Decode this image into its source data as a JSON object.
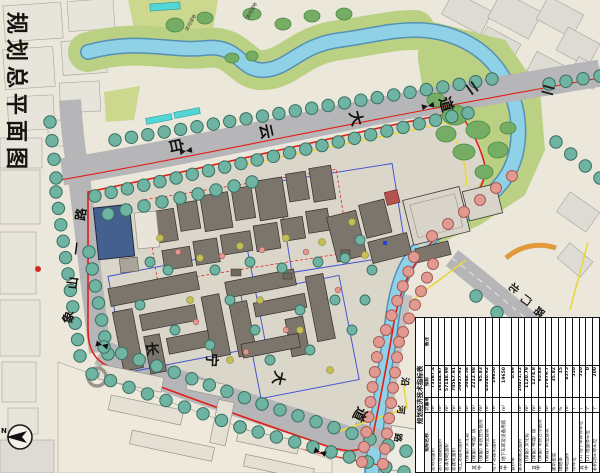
{
  "sheet": {
    "title": "规划总平面图"
  },
  "map": {
    "road_labels": [
      {
        "name": "白云大道",
        "chars": [
          "白",
          "云",
          "大",
          "道"
        ]
      },
      {
        "name": "象山一路",
        "chars": [
          "象",
          "山",
          "一",
          "路"
        ]
      },
      {
        "name": "长宁大道",
        "chars": [
          "长",
          "宁",
          "大",
          "道"
        ]
      },
      {
        "name": "北门路",
        "chars": [
          "北",
          "门",
          "路"
        ]
      },
      {
        "name": "沿河路",
        "chars": [
          "沿",
          "河",
          "路"
        ]
      }
    ],
    "riverside_labels": [
      "滨河绿地",
      "滨河绿地"
    ],
    "compass_label": "N",
    "colors": {
      "river": "#8fd1e6",
      "bank_green": "#bad183",
      "boundary_red": "#e21e14",
      "boundary_yellow": "#ead73c",
      "control_blue": "#2b3fd6",
      "street_tree": "#6fb3a2",
      "flower_tree": "#e09a92",
      "road_gray": "#b6b5b8"
    }
  },
  "table": {
    "title": "规划经济技术指标表",
    "headers": {
      "name": "指标名称",
      "unit": "计量单位",
      "value": "指标",
      "remark": "备注"
    },
    "rows": [
      {
        "label": "总用地面积",
        "unit": "m²",
        "value": "73267.4",
        "remark": ""
      },
      {
        "label": "总代征道路面积",
        "unit": "m²",
        "value": "16144.67",
        "remark": ""
      },
      {
        "label": "总净用地面积",
        "unit": "m²",
        "value": "57148.99",
        "remark": ""
      },
      {
        "label": "总建筑面积",
        "unit": "m²",
        "value": "70567.91",
        "remark": ""
      },
      {
        "label": "地上总建筑面积",
        "unit": "m²",
        "value": "50917.91",
        "remark": ""
      },
      {
        "group": "其中",
        "label": "(保留) 文化馆",
        "unit": "m²",
        "value": "5048.58",
        "remark": ""
      },
      {
        "group": "其中",
        "label": "(保留) 啤酒厂房",
        "unit": "m²",
        "value": "2212.98",
        "remark": ""
      },
      {
        "group": "其中",
        "label": "(保留) 军民合作医院",
        "unit": "m²",
        "value": "95.83",
        "remark": ""
      },
      {
        "group": "其中",
        "label": "(新建) 商业建筑",
        "unit": "m²",
        "value": "43040.92",
        "remark": ""
      },
      {
        "label": "地下总建筑面积",
        "unit": "m²",
        "value": "19650",
        "remark": ""
      },
      {
        "group": "其中",
        "label": "地下车库及设备用房",
        "unit": "m²",
        "value": "19650",
        "remark": ""
      },
      {
        "label": "容积率",
        "unit": "",
        "value": "0.89",
        "remark": ""
      },
      {
        "label": "建筑基底总面积",
        "unit": "m²",
        "value": "20471.12",
        "remark": ""
      },
      {
        "group": "其中",
        "label": "(保留) 文化馆",
        "unit": "m²",
        "value": "1120.79",
        "remark": ""
      },
      {
        "group": "其中",
        "label": "(保留) 啤酒厂房",
        "unit": "m²",
        "value": "1274.8",
        "remark": ""
      },
      {
        "group": "其中",
        "label": "(保留) 军民合作医院",
        "unit": "m²",
        "value": "95.83",
        "remark": ""
      },
      {
        "group": "其中",
        "label": "(新建) 商业建筑",
        "unit": "m²",
        "value": "17979.7",
        "remark": ""
      },
      {
        "label": "建筑密度",
        "unit": "%",
        "value": "35.82",
        "remark": ""
      },
      {
        "label": "绿地率",
        "unit": "%",
        "value": "15",
        "remark": ""
      },
      {
        "label": "绿地面积",
        "unit": "m²",
        "value": "8575",
        "remark": ""
      },
      {
        "label": "停车位",
        "unit": "个",
        "value": "510",
        "remark": ""
      },
      {
        "group": "其中",
        "label": "(1) 地下车库停车位",
        "unit": "个",
        "value": "510",
        "remark": ""
      },
      {
        "group": "其中",
        "label": "(2) 地面停车位",
        "unit": "个",
        "value": "0",
        "remark": ""
      },
      {
        "label": "非机动车停车位",
        "unit": "个",
        "value": "200",
        "remark": ""
      }
    ]
  }
}
